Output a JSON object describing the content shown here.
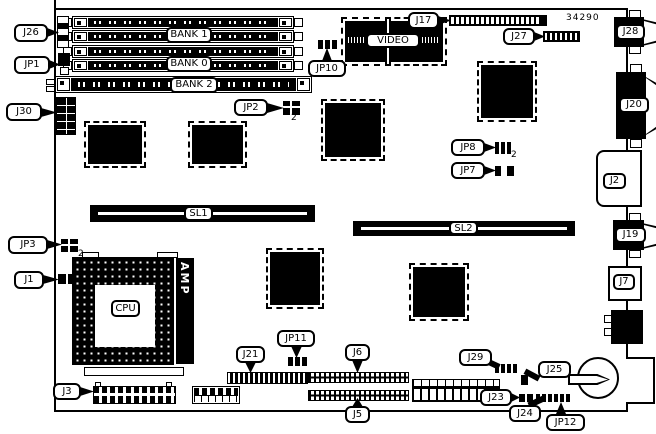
{
  "colors": {
    "ink": "#000000",
    "paper": "#ffffff"
  },
  "board": {
    "part_number": "34290"
  },
  "callouts": {
    "j26": "J26",
    "jp1": "JP1",
    "j30": "J30",
    "jp3": "JP3",
    "j1": "J1",
    "j3": "J3",
    "bank1": "BANK 1",
    "bank0": "BANK 0",
    "bank2": "BANK 2",
    "video": "VIDEO",
    "jp10": "JP10",
    "jp2": "JP2",
    "j17": "J17",
    "j27": "J27",
    "j28": "J28",
    "j20": "J20",
    "j2": "J2",
    "j19": "J19",
    "j7": "J7",
    "jp8": "JP8",
    "jp7": "JP7",
    "sl1": "SL1",
    "sl2": "SL2",
    "cpu": "CPU",
    "amp": "AMP",
    "j21": "J21",
    "jp11": "JP11",
    "j6": "J6",
    "j5": "J5",
    "j29": "J29",
    "j25": "J25",
    "j23": "J23",
    "j24": "J24",
    "jp12": "JP12"
  },
  "subscripts": {
    "jp3": "2",
    "jp2": "2",
    "jp8": "2"
  }
}
